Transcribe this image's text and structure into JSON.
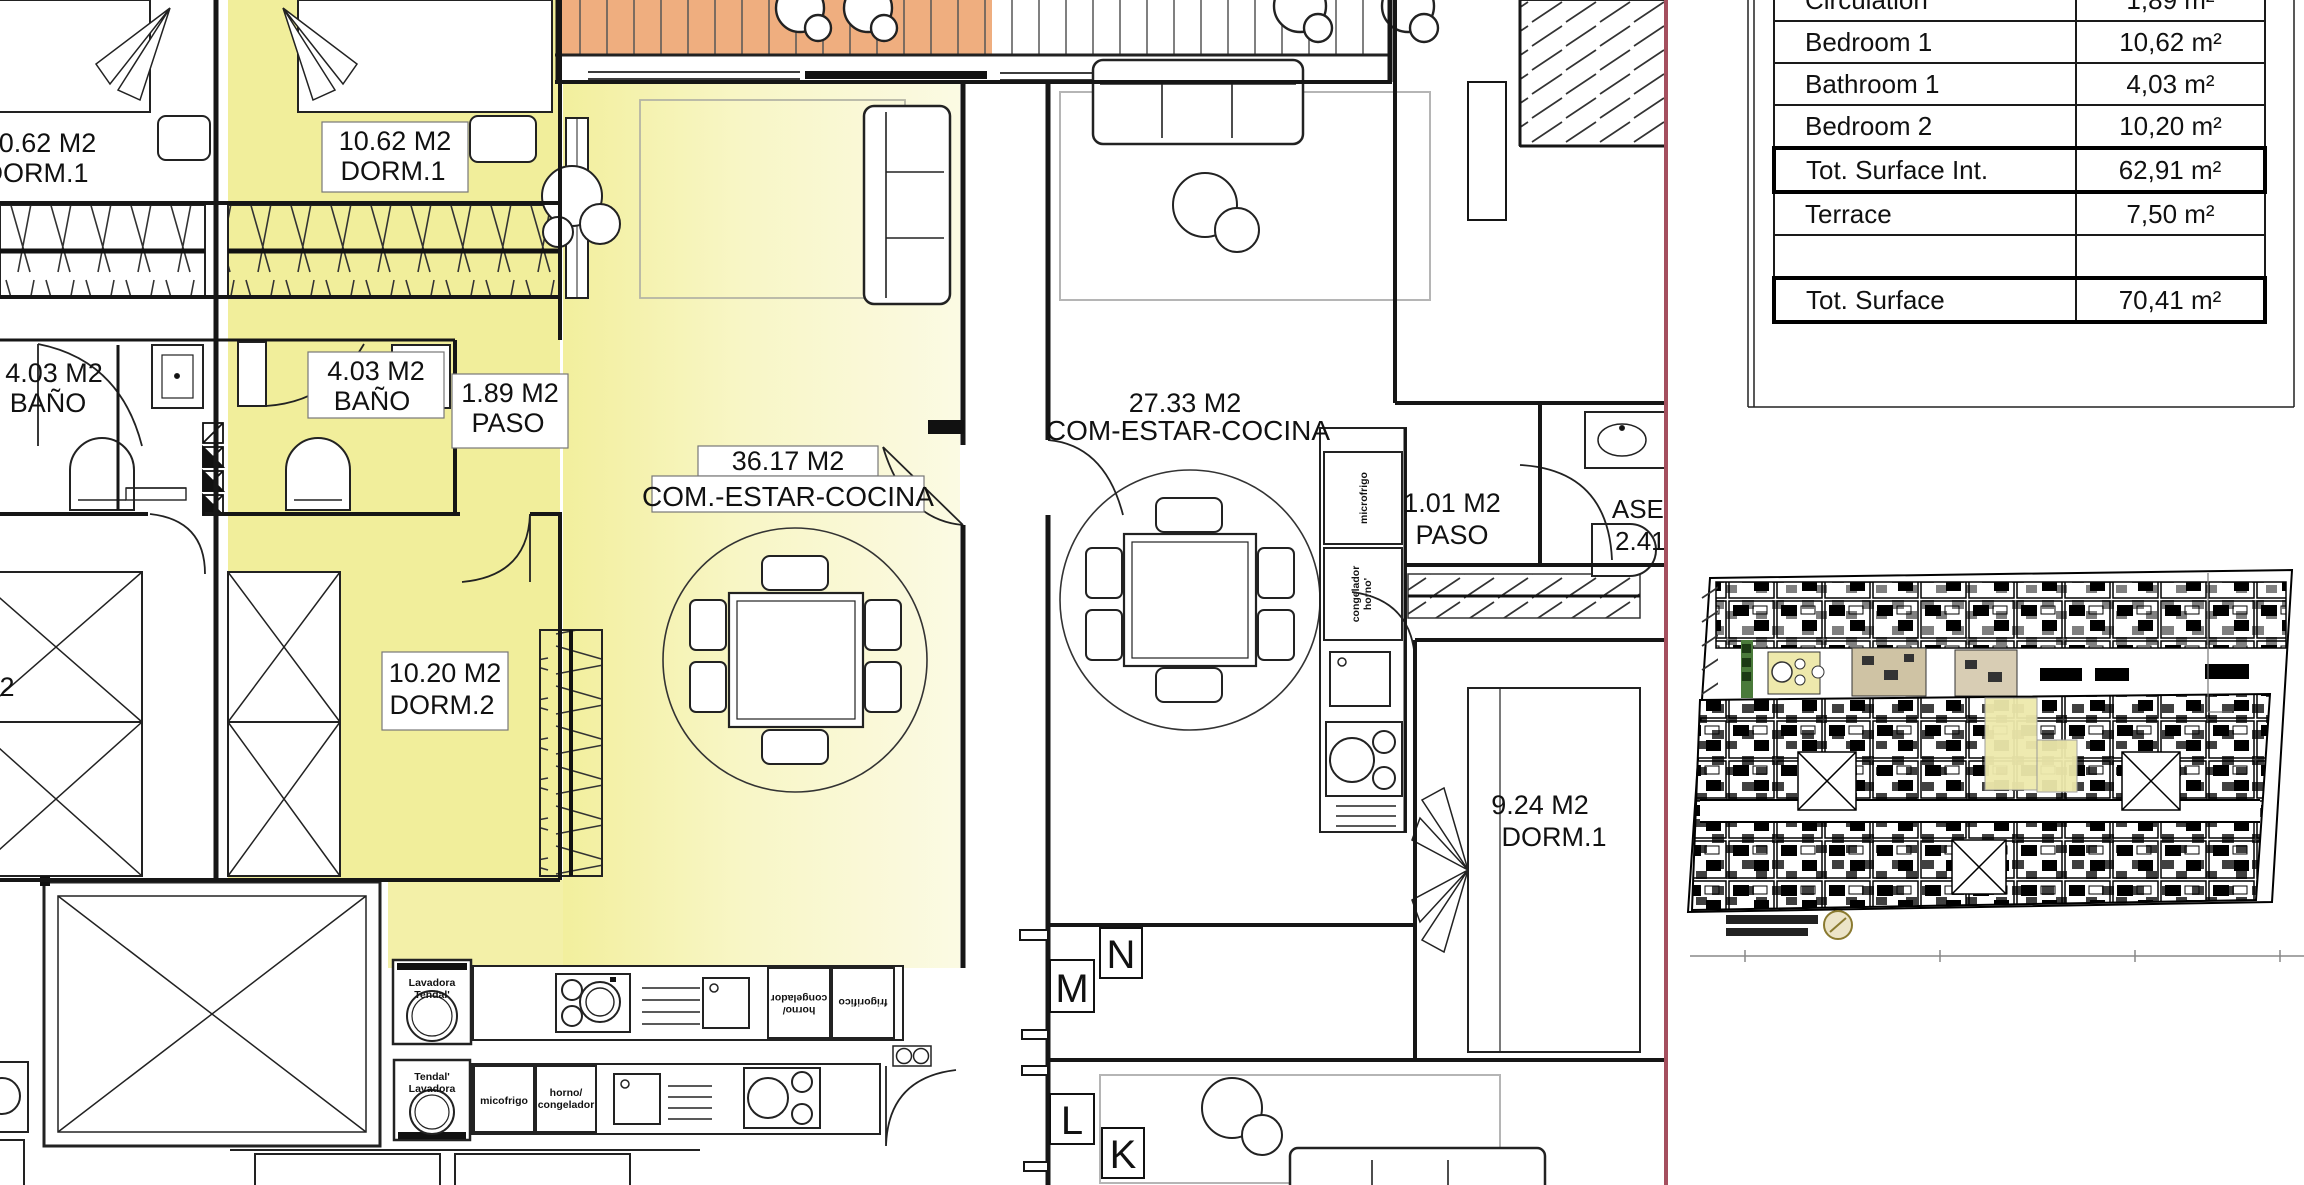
{
  "table": {
    "rows": [
      {
        "label": "Circulation",
        "value": "1,89 m²"
      },
      {
        "label": "Bedroom 1",
        "value": "10,62 m²"
      },
      {
        "label": "Bathroom 1",
        "value": "4,03 m²"
      },
      {
        "label": "Bedroom 2",
        "value": "10,20 m²"
      },
      {
        "label": "Tot. Surface Int.",
        "value": "62,91 m²"
      },
      {
        "label": "Terrace",
        "value": "7,50 m²"
      },
      {
        "label": "",
        "value": ""
      },
      {
        "label": "Tot. Surface",
        "value": "70,41 m²"
      }
    ]
  },
  "plan": {
    "left_unit": {
      "dorm1_area": "10.62 M2",
      "dorm1_name": "DORM.1",
      "bath_area": "4.03 M2",
      "bath_name": "BAÑO",
      "dorm2_name": "DORM.2"
    },
    "unit": {
      "dorm1_area": "10.62 M2",
      "dorm1_name": "DORM.1",
      "bath_area": "4.03 M2",
      "bath_name": "BAÑO",
      "paso_area": "1.89 M2",
      "paso_name": "PASO",
      "living_area": "36.17 M2",
      "living_name": "COM.-ESTAR-COCINA",
      "dorm2_area": "10.20 M2",
      "dorm2_name": "DORM.2"
    },
    "right_unit": {
      "living_area": "27.33 M2",
      "living_name": "COM-ESTAR-COCINA",
      "paso_area": "1.01 M2",
      "paso_name": "PASO",
      "aseo_name": "ASEO",
      "aseo_area": "2.41 M2",
      "dorm1_area": "9.24 M2",
      "dorm1_name": "DORM.1"
    },
    "markers": {
      "n": "N",
      "m": "M",
      "l": "L",
      "k": "K"
    },
    "appliances": {
      "washer_top_1": "Lavadora",
      "washer_top_2": "Tendal'",
      "washer_bottom_1": "Tendal'",
      "washer_bottom_2": "Lavadora",
      "oven_fridge_1": "horno/",
      "oven_fridge_2": "congelador",
      "fridge": "frigorifico",
      "micro_bottom": "micofrigo",
      "oven_bottom_1": "horno/",
      "oven_bottom_2": "congelador",
      "micro_right": "microfrigo",
      "freezer_right_1": "congelador",
      "freezer_right_2": "horno'"
    }
  },
  "colors": {
    "highlight_yellow": "#f1ee9b",
    "terrace_salmon": "#efae7f",
    "divider_red": "#a44f5e"
  }
}
